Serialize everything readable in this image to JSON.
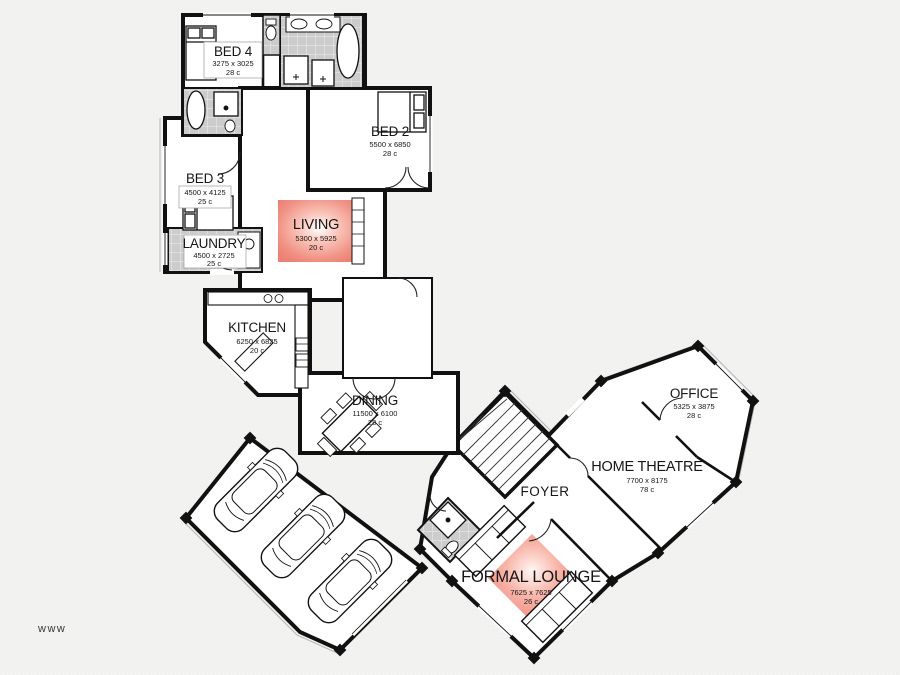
{
  "watermark": "www",
  "colors": {
    "wall": "#111111",
    "plan_fill": "#ffffff",
    "tile_fill": "#cccccc",
    "highlight": "#ee8275",
    "canvas": "#f2f2f1"
  },
  "rooms": {
    "bed4": {
      "name": "BED 4",
      "dims": "3275 x 3025",
      "area": "28 c"
    },
    "bed2": {
      "name": "BED 2",
      "dims": "5500 x 6850",
      "area": "28 c"
    },
    "bed3": {
      "name": "BED 3",
      "dims": "4500 x 4125",
      "area": "25 c"
    },
    "laundry": {
      "name": "LAUNDRY",
      "dims": "4500 x 2725",
      "area": "25 c"
    },
    "living": {
      "name": "LIVING",
      "dims": "5300 x 5925",
      "area": "20 c"
    },
    "kitchen": {
      "name": "KITCHEN",
      "dims": "6250 x 6825",
      "area": "20 c"
    },
    "dining": {
      "name": "DINING",
      "dims": "11500 x 6100",
      "area": "28 c"
    },
    "office": {
      "name": "OFFICE",
      "dims": "5325 x 3875",
      "area": "28 c"
    },
    "home_theatre": {
      "name": "HOME THEATRE",
      "dims": "7700 x 8175",
      "area": "78 c"
    },
    "foyer": {
      "name": "FOYER"
    },
    "formal_lounge": {
      "name": "FORMAL LOUNGE",
      "dims": "7625 x 7625",
      "area": "26 c"
    }
  }
}
